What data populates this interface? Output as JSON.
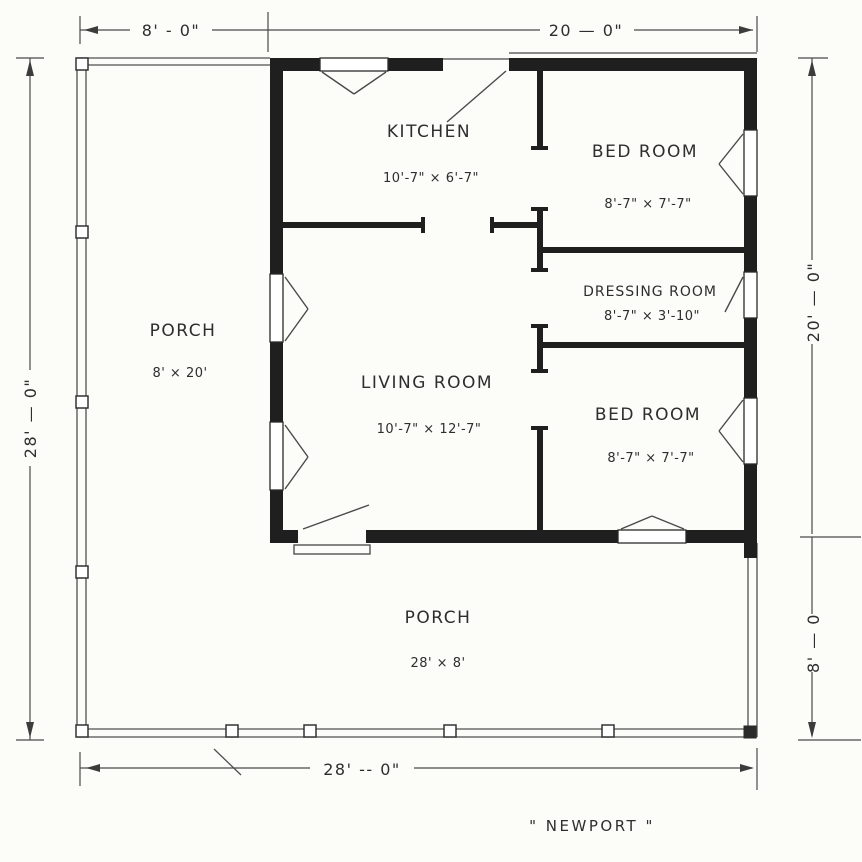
{
  "drawing_title": "\" NEWPORT \"",
  "rooms": {
    "kitchen": {
      "name": "KITCHEN",
      "size": "10'-7\" × 6'-7\""
    },
    "bedroom_top": {
      "name": "BED ROOM",
      "size": "8'-7\" × 7'-7\""
    },
    "dressing_room": {
      "name": "DRESSING ROOM",
      "size": "8'-7\" × 3'-10\""
    },
    "living_room": {
      "name": "LIVING ROOM",
      "size": "10'-7\" × 12'-7\""
    },
    "bedroom_bottom": {
      "name": "BED ROOM",
      "size": "8'-7\" × 7'-7\""
    },
    "porch_left": {
      "name": "PORCH",
      "size": "8' × 20'"
    },
    "porch_bottom": {
      "name": "PORCH",
      "size": "28' × 8'"
    }
  },
  "dimensions": {
    "top_left": "8' - 0\"",
    "top_right": "20 — 0\"",
    "left": "28' — 0\"",
    "right_upper": "20' — 0\"",
    "right_lower": "8' — 0",
    "bottom": "28' -- 0\""
  },
  "colors": {
    "paper": "#fcfcf9",
    "ink": "#2e2e2e",
    "wall": "#1f1f1f"
  }
}
